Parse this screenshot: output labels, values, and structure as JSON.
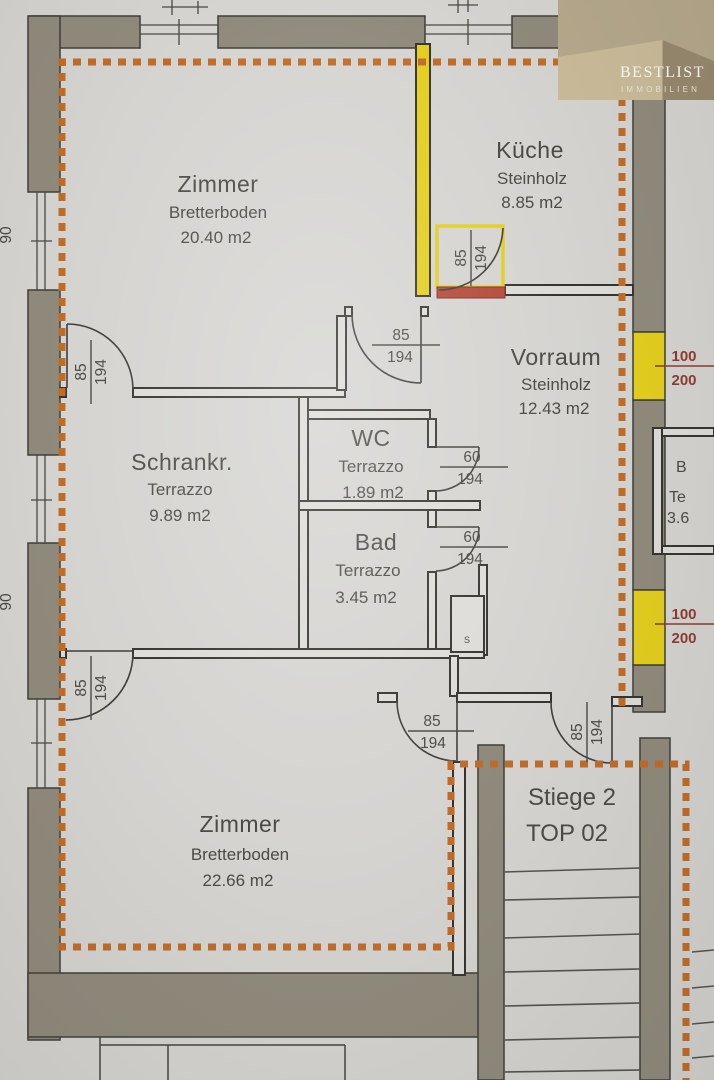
{
  "logo": {
    "brand": "BESTLIST",
    "sub": "IMMOBILIEN"
  },
  "rooms": {
    "zimmer1": {
      "name": "Zimmer",
      "floor": "Bretterboden",
      "area": "20.40 m2"
    },
    "kueche": {
      "name": "Küche",
      "floor": "Steinholz",
      "area": "8.85 m2"
    },
    "vorraum": {
      "name": "Vorraum",
      "floor": "Steinholz",
      "area": "12.43 m2"
    },
    "schrank": {
      "name": "Schrankr.",
      "floor": "Terrazzo",
      "area": "9.89 m2"
    },
    "wc": {
      "name": "WC",
      "floor": "Terrazzo",
      "area": "1.89 m2"
    },
    "bad": {
      "name": "Bad",
      "floor": "Terrazzo",
      "area": "3.45 m2"
    },
    "zimmer2": {
      "name": "Zimmer",
      "floor": "Bretterboden",
      "area": "22.66 m2"
    }
  },
  "stairwell": {
    "line1": "Stiege 2",
    "line2": "TOP 02"
  },
  "dims": {
    "door85": {
      "w": "85",
      "h": "194"
    },
    "door60": {
      "w": "60",
      "h": "194"
    },
    "window100": {
      "w": "100",
      "h": "200"
    },
    "edge_fragment": "90",
    "shaft_mark": "S"
  },
  "neighbor": {
    "line1": "B",
    "line2": "Te",
    "line3": "3.6"
  },
  "colors": {
    "outline_orange": "#bf6c2a",
    "wall_gray": "#8f8a7c",
    "window_yellow": "#e3ce1e",
    "sill_red": "#b3493a",
    "dim_red": "#8e3a33"
  }
}
